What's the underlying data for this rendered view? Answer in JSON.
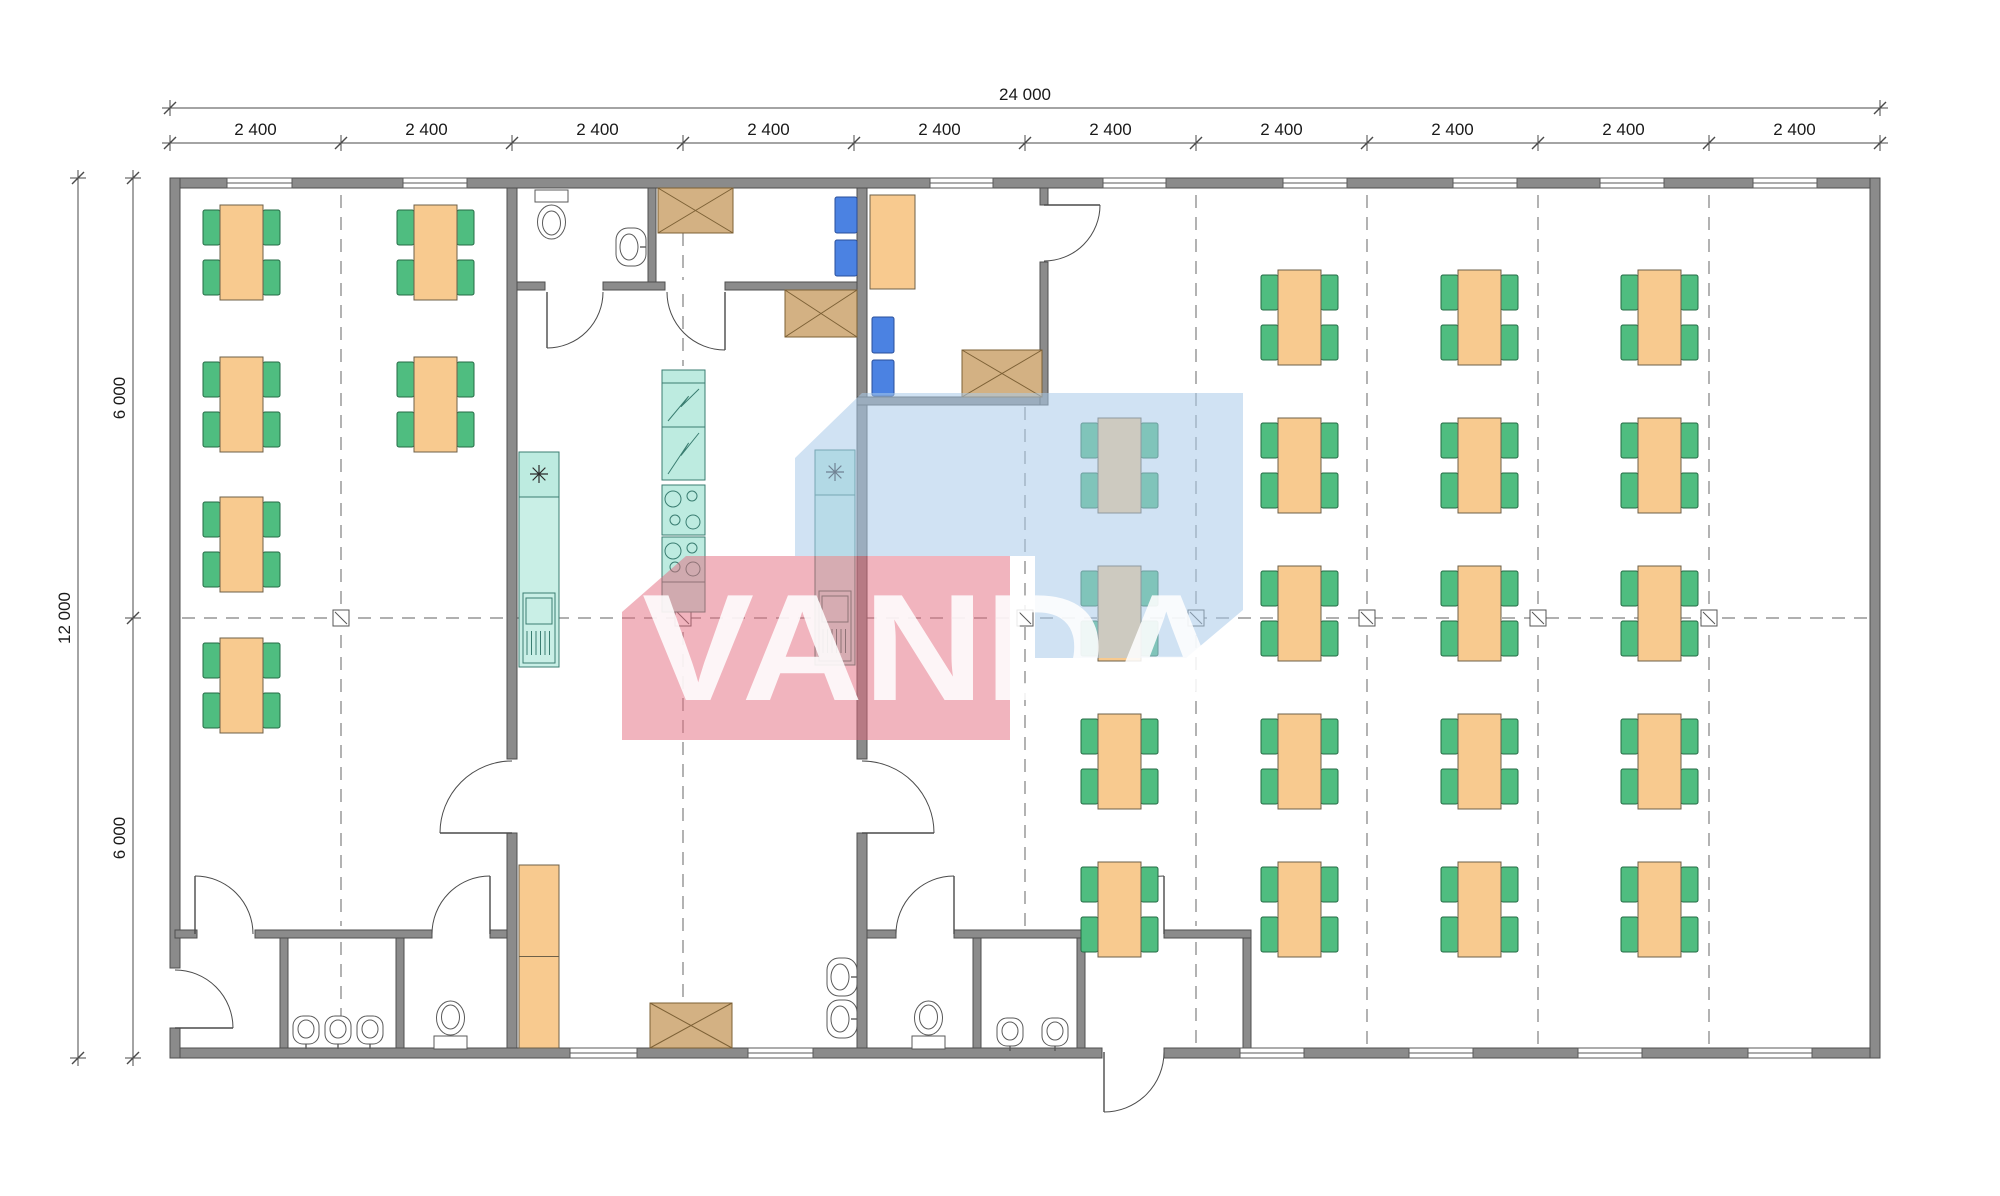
{
  "canvas": {
    "w": 2000,
    "h": 1196,
    "bg": "#ffffff"
  },
  "palette": {
    "wall": "#8b8b8b",
    "wallStroke": "#4f4f4f",
    "table": "#F8CA8F",
    "tableStroke": "#6e6048",
    "chair": "#4FBD80",
    "chairStroke": "#256b45",
    "teal": "#BDEBE0",
    "tealStroke": "#3a7d71",
    "tan": "#D3B183",
    "tanStroke": "#7d6136",
    "blue": "#4B82E2",
    "blueStroke": "#2a4f9b",
    "fixture": "#ffffff",
    "fixtureStroke": "#5a5a5a",
    "grid": "#808080",
    "dimLine": "#4a4a4a",
    "dimText": "#1a1a1a",
    "wmBlue": "#A9CBE9",
    "wmRed": "#E4697D",
    "wmText": "#ffffff"
  },
  "dimensions": {
    "top_total": {
      "label": "24 000"
    },
    "top_segments": [
      "2 400",
      "2 400",
      "2 400",
      "2 400",
      "2 400",
      "2 400",
      "2 400",
      "2 400",
      "2 400",
      "2 400"
    ],
    "left_total": {
      "label": "12 000"
    },
    "left_segments": [
      "6 000",
      "6 000"
    ]
  },
  "dim_geo": {
    "top1": {
      "y": 108,
      "x1": 170,
      "x2": 1880
    },
    "top2": {
      "y": 143,
      "ticks": [
        170,
        341,
        512,
        683,
        854,
        1025,
        1196,
        1367,
        1538,
        1709,
        1880
      ]
    },
    "left1": {
      "x": 78,
      "y1": 178,
      "y2": 1058
    },
    "left2": {
      "x": 133,
      "ticks": [
        178,
        618,
        1058
      ]
    }
  },
  "watermark": {
    "text": "VANDA",
    "blue_poly": [
      [
        862,
        393
      ],
      [
        1243,
        393
      ],
      [
        1243,
        610
      ],
      [
        1186,
        658
      ],
      [
        1035,
        658
      ],
      [
        1035,
        556
      ],
      [
        795,
        556
      ],
      [
        795,
        458
      ]
    ],
    "red_poly": [
      [
        686,
        556
      ],
      [
        1010,
        556
      ],
      [
        1010,
        740
      ],
      [
        622,
        740
      ],
      [
        622,
        612
      ]
    ],
    "text_x": 642,
    "text_y": 700,
    "text_length": 585,
    "font_size": 152
  },
  "prims": [
    {
      "t": "dash",
      "n": "grid-line-horizontal",
      "x1": 182,
      "y1": 618,
      "x2": 1868,
      "y2": 618
    },
    {
      "t": "dash",
      "n": "grid-line-vertical",
      "x1": 341,
      "y1": 195,
      "x2": 341,
      "y2": 926
    },
    {
      "t": "dash",
      "n": "grid-line-vertical",
      "x1": 341,
      "y1": 942,
      "x2": 341,
      "y2": 1044
    },
    {
      "t": "dash",
      "n": "grid-line-vertical",
      "x1": 683,
      "y1": 233,
      "x2": 683,
      "y2": 280
    },
    {
      "t": "dash",
      "n": "grid-line-vertical",
      "x1": 683,
      "y1": 294,
      "x2": 683,
      "y2": 366
    },
    {
      "t": "dash",
      "n": "grid-line-vertical",
      "x1": 683,
      "y1": 632,
      "x2": 683,
      "y2": 1000
    },
    {
      "t": "dash",
      "n": "grid-line-vertical",
      "x1": 1025,
      "y1": 407,
      "x2": 1025,
      "y2": 926
    },
    {
      "t": "dash",
      "n": "grid-line-vertical",
      "x1": 1196,
      "y1": 195,
      "x2": 1196,
      "y2": 926
    },
    {
      "t": "dash",
      "n": "grid-line-vertical",
      "x1": 1196,
      "y1": 942,
      "x2": 1196,
      "y2": 1044
    },
    {
      "t": "dash",
      "n": "grid-line-vertical",
      "x1": 1367,
      "y1": 195,
      "x2": 1367,
      "y2": 1044
    },
    {
      "t": "dash",
      "n": "grid-line-vertical",
      "x1": 1538,
      "y1": 195,
      "x2": 1538,
      "y2": 1044
    },
    {
      "t": "dash",
      "n": "grid-line-vertical",
      "x1": 1709,
      "y1": 195,
      "x2": 1709,
      "y2": 1044
    },
    {
      "t": "marker",
      "n": "grid-marker",
      "x": 333,
      "y": 610
    },
    {
      "t": "marker",
      "n": "grid-marker",
      "x": 675,
      "y": 610
    },
    {
      "t": "marker",
      "n": "grid-marker",
      "x": 1017,
      "y": 610
    },
    {
      "t": "marker",
      "n": "grid-marker",
      "x": 1188,
      "y": 610
    },
    {
      "t": "marker",
      "n": "grid-marker",
      "x": 1359,
      "y": 610
    },
    {
      "t": "marker",
      "n": "grid-marker",
      "x": 1530,
      "y": 610
    },
    {
      "t": "marker",
      "n": "grid-marker",
      "x": 1701,
      "y": 610
    },
    {
      "t": "wall",
      "n": "outer-wall-top",
      "x": 170,
      "y": 178,
      "w": 1710,
      "h": 10
    },
    {
      "t": "wall",
      "n": "outer-wall-bottom-left",
      "x": 170,
      "y": 1048,
      "w": 932,
      "h": 10
    },
    {
      "t": "wall",
      "n": "outer-wall-bottom-right",
      "x": 1164,
      "y": 1048,
      "w": 716,
      "h": 10
    },
    {
      "t": "wall",
      "n": "outer-wall-left-upper",
      "x": 170,
      "y": 178,
      "w": 10,
      "h": 790
    },
    {
      "t": "wall",
      "n": "outer-wall-left-lower",
      "x": 170,
      "y": 1028,
      "w": 10,
      "h": 30
    },
    {
      "t": "wall",
      "n": "outer-wall-right",
      "x": 1870,
      "y": 178,
      "w": 10,
      "h": 880
    },
    {
      "t": "wall",
      "n": "kitchen-west-wall-upper",
      "x": 507,
      "y": 188,
      "w": 10,
      "h": 571
    },
    {
      "t": "wall",
      "n": "kitchen-west-wall-lower",
      "x": 507,
      "y": 833,
      "w": 10,
      "h": 215
    },
    {
      "t": "wall",
      "n": "kitchen-east-wall-upper",
      "x": 857,
      "y": 188,
      "w": 10,
      "h": 571
    },
    {
      "t": "wall",
      "n": "kitchen-east-wall-lower",
      "x": 857,
      "y": 833,
      "w": 10,
      "h": 215
    },
    {
      "t": "wall",
      "n": "wc-top-block-wall",
      "x": 517,
      "y": 282,
      "w": 28,
      "h": 8
    },
    {
      "t": "wall",
      "n": "wc-top-block-wall",
      "x": 603,
      "y": 282,
      "w": 62,
      "h": 8
    },
    {
      "t": "wall",
      "n": "wc-top-block-wall",
      "x": 725,
      "y": 282,
      "w": 132,
      "h": 8
    },
    {
      "t": "wall",
      "n": "wc-divider-wall",
      "x": 648,
      "y": 188,
      "w": 8,
      "h": 94
    },
    {
      "t": "wall",
      "n": "office-south-wall",
      "x": 857,
      "y": 397,
      "w": 191,
      "h": 8
    },
    {
      "t": "wall",
      "n": "office-east-wall",
      "x": 1040,
      "y": 188,
      "w": 8,
      "h": 17
    },
    {
      "t": "wall",
      "n": "office-east-wall",
      "x": 1040,
      "y": 262,
      "w": 8,
      "h": 143
    },
    {
      "t": "wall",
      "n": "sw-block-top-wall",
      "x": 175,
      "y": 930,
      "w": 22,
      "h": 8
    },
    {
      "t": "wall",
      "n": "sw-block-top-wall",
      "x": 255,
      "y": 930,
      "w": 177,
      "h": 8
    },
    {
      "t": "wall",
      "n": "sw-block-top-wall",
      "x": 490,
      "y": 930,
      "w": 17,
      "h": 8
    },
    {
      "t": "wall",
      "n": "vestibule-washroom-divider",
      "x": 280,
      "y": 938,
      "w": 8,
      "h": 110
    },
    {
      "t": "wall",
      "n": "washroom-wc-divider",
      "x": 396,
      "y": 938,
      "w": 8,
      "h": 110
    },
    {
      "t": "wall",
      "n": "south-block-top-wall",
      "x": 867,
      "y": 930,
      "w": 29,
      "h": 8
    },
    {
      "t": "wall",
      "n": "south-block-top-wall",
      "x": 954,
      "y": 930,
      "w": 152,
      "h": 8
    },
    {
      "t": "wall",
      "n": "south-block-top-wall",
      "x": 1164,
      "y": 930,
      "w": 87,
      "h": 8
    },
    {
      "t": "wall",
      "n": "south-wc-divider",
      "x": 973,
      "y": 938,
      "w": 8,
      "h": 110
    },
    {
      "t": "wall",
      "n": "south-washroom-divider",
      "x": 1077,
      "y": 938,
      "w": 8,
      "h": 110
    },
    {
      "t": "wall",
      "n": "south-vestibule-east-wall",
      "x": 1243,
      "y": 938,
      "w": 8,
      "h": 110
    },
    {
      "t": "window",
      "n": "window",
      "x": 227,
      "y": 178,
      "w": 65
    },
    {
      "t": "window",
      "n": "window",
      "x": 403,
      "y": 178,
      "w": 64
    },
    {
      "t": "window",
      "n": "window",
      "x": 930,
      "y": 178,
      "w": 63
    },
    {
      "t": "window",
      "n": "window",
      "x": 1103,
      "y": 178,
      "w": 63
    },
    {
      "t": "window",
      "n": "window",
      "x": 1283,
      "y": 178,
      "w": 64
    },
    {
      "t": "window",
      "n": "window",
      "x": 1453,
      "y": 178,
      "w": 64
    },
    {
      "t": "window",
      "n": "window",
      "x": 1600,
      "y": 178,
      "w": 64
    },
    {
      "t": "window",
      "n": "window",
      "x": 1753,
      "y": 178,
      "w": 64
    },
    {
      "t": "window",
      "n": "window",
      "x": 570,
      "y": 1048,
      "w": 67
    },
    {
      "t": "window",
      "n": "window",
      "x": 748,
      "y": 1048,
      "w": 65
    },
    {
      "t": "window",
      "n": "window",
      "x": 1240,
      "y": 1048,
      "w": 64
    },
    {
      "t": "window",
      "n": "window",
      "x": 1409,
      "y": 1048,
      "w": 64
    },
    {
      "t": "window",
      "n": "window",
      "x": 1578,
      "y": 1048,
      "w": 64
    },
    {
      "t": "window",
      "n": "window",
      "x": 1748,
      "y": 1048,
      "w": 64
    },
    {
      "t": "door",
      "n": "door-wc-top",
      "p": [
        547,
        292
      ],
      "r": 56,
      "a1": 0,
      "a2": 90,
      "sweep": 1
    },
    {
      "t": "door",
      "n": "door-lobby-top",
      "p": [
        725,
        292
      ],
      "r": 58,
      "a1": 180,
      "a2": 90,
      "sweep": 0
    },
    {
      "t": "door",
      "n": "door-office",
      "p": [
        1044,
        205
      ],
      "r": 56,
      "a1": 90,
      "a2": 0,
      "sweep": 0
    },
    {
      "t": "door",
      "n": "door-kitchen-west",
      "p": [
        512,
        833
      ],
      "r": 72,
      "a1": 270,
      "a2": 180,
      "sweep": 0
    },
    {
      "t": "door",
      "n": "door-kitchen-east",
      "p": [
        862,
        833
      ],
      "r": 72,
      "a1": 270,
      "a2": 360,
      "sweep": 1
    },
    {
      "t": "door",
      "n": "door-vestibule-left",
      "p": [
        195,
        934
      ],
      "r": 58,
      "a1": 0,
      "a2": 270,
      "sweep": 0
    },
    {
      "t": "door",
      "n": "door-wc-southwest",
      "p": [
        490,
        934
      ],
      "r": 58,
      "a1": 180,
      "a2": 270,
      "sweep": 1
    },
    {
      "t": "door",
      "n": "door-entrance-left",
      "p": [
        175,
        1028
      ],
      "r": 58,
      "a1": 270,
      "a2": 360,
      "sweep": 1
    },
    {
      "t": "door",
      "n": "door-wc-south",
      "p": [
        954,
        934
      ],
      "r": 58,
      "a1": 180,
      "a2": 270,
      "sweep": 1
    },
    {
      "t": "door",
      "n": "door-vestibule-south",
      "p": [
        1164,
        934
      ],
      "r": 58,
      "a1": 180,
      "a2": 270,
      "sweep": 1
    },
    {
      "t": "door",
      "n": "door-entrance-south",
      "p": [
        1104,
        1052
      ],
      "r": 60,
      "a1": 0,
      "a2": 90,
      "sweep": 1
    },
    {
      "t": "vtable",
      "n": "dining-table",
      "x": 220,
      "y": 205
    },
    {
      "t": "vtable",
      "n": "dining-table",
      "x": 220,
      "y": 357
    },
    {
      "t": "vtable",
      "n": "dining-table",
      "x": 220,
      "y": 497
    },
    {
      "t": "vtable",
      "n": "dining-table",
      "x": 220,
      "y": 638
    },
    {
      "t": "vtable",
      "n": "dining-table",
      "x": 414,
      "y": 205
    },
    {
      "t": "vtable",
      "n": "dining-table",
      "x": 414,
      "y": 357
    },
    {
      "t": "vtable",
      "n": "dining-table",
      "x": 1098,
      "y": 418
    },
    {
      "t": "vtable",
      "n": "dining-table",
      "x": 1098,
      "y": 566
    },
    {
      "t": "vtable",
      "n": "dining-table",
      "x": 1098,
      "y": 714
    },
    {
      "t": "vtable",
      "n": "dining-table",
      "x": 1098,
      "y": 862
    },
    {
      "t": "vtable",
      "n": "dining-table",
      "x": 1278,
      "y": 270
    },
    {
      "t": "vtable",
      "n": "dining-table",
      "x": 1278,
      "y": 418
    },
    {
      "t": "vtable",
      "n": "dining-table",
      "x": 1278,
      "y": 566
    },
    {
      "t": "vtable",
      "n": "dining-table",
      "x": 1278,
      "y": 714
    },
    {
      "t": "vtable",
      "n": "dining-table",
      "x": 1278,
      "y": 862
    },
    {
      "t": "vtable",
      "n": "dining-table",
      "x": 1458,
      "y": 270
    },
    {
      "t": "vtable",
      "n": "dining-table",
      "x": 1458,
      "y": 418
    },
    {
      "t": "vtable",
      "n": "dining-table",
      "x": 1458,
      "y": 566
    },
    {
      "t": "vtable",
      "n": "dining-table",
      "x": 1458,
      "y": 714
    },
    {
      "t": "vtable",
      "n": "dining-table",
      "x": 1458,
      "y": 862
    },
    {
      "t": "vtable",
      "n": "dining-table",
      "x": 1638,
      "y": 270
    },
    {
      "t": "vtable",
      "n": "dining-table",
      "x": 1638,
      "y": 418
    },
    {
      "t": "vtable",
      "n": "dining-table",
      "x": 1638,
      "y": 566
    },
    {
      "t": "vtable",
      "n": "dining-table",
      "x": 1638,
      "y": 714
    },
    {
      "t": "vtable",
      "n": "dining-table",
      "x": 1638,
      "y": 862
    },
    {
      "t": "rect",
      "n": "office-desk",
      "x": 870,
      "y": 195,
      "w": 45,
      "h": 94,
      "fill": "table",
      "stroke": "tableStroke"
    },
    {
      "t": "chairb",
      "n": "blue-chair",
      "x": 835,
      "y": 197
    },
    {
      "t": "chairb",
      "n": "blue-chair",
      "x": 835,
      "y": 240
    },
    {
      "t": "chairb",
      "n": "blue-chair",
      "x": 872,
      "y": 317
    },
    {
      "t": "chairb",
      "n": "blue-chair",
      "x": 872,
      "y": 360
    },
    {
      "t": "xbox",
      "n": "cabinet-crossed",
      "x": 658,
      "y": 188,
      "w": 75,
      "h": 45
    },
    {
      "t": "xbox",
      "n": "cabinet-crossed",
      "x": 785,
      "y": 290,
      "w": 72,
      "h": 47
    },
    {
      "t": "xbox",
      "n": "cabinet-crossed",
      "x": 962,
      "y": 350,
      "w": 80,
      "h": 47
    },
    {
      "t": "xbox",
      "n": "cabinet-crossed",
      "x": 650,
      "y": 1003,
      "w": 82,
      "h": 45
    },
    {
      "t": "counter",
      "n": "kitchen-counter-west",
      "x": 519,
      "y": 452,
      "w": 40,
      "h": 215
    },
    {
      "t": "counter",
      "n": "kitchen-counter-east",
      "x": 815,
      "y": 450,
      "w": 40,
      "h": 215
    },
    {
      "t": "stack",
      "n": "kitchen-appliance-stack",
      "x": 662,
      "y": 370,
      "w": 43
    },
    {
      "t": "cab",
      "n": "kitchen-cabinet",
      "x": 519,
      "y": 865,
      "w": 40,
      "h": 183
    },
    {
      "t": "toilet",
      "n": "toilet",
      "x": 535,
      "y": 190,
      "dir": "down"
    },
    {
      "t": "toilet",
      "n": "toilet",
      "x": 434,
      "y": 1000,
      "dir": "up"
    },
    {
      "t": "toilet",
      "n": "toilet",
      "x": 912,
      "y": 1000,
      "dir": "up"
    },
    {
      "t": "sink",
      "n": "wall-sink",
      "x": 616,
      "y": 228
    },
    {
      "t": "sink",
      "n": "wall-sink",
      "x": 827,
      "y": 958
    },
    {
      "t": "sink",
      "n": "wall-sink",
      "x": 827,
      "y": 1000
    },
    {
      "t": "basin",
      "n": "wash-basin",
      "cx": 306,
      "cy": 1030
    },
    {
      "t": "basin",
      "n": "wash-basin",
      "cx": 338,
      "cy": 1030
    },
    {
      "t": "basin",
      "n": "wash-basin",
      "cx": 370,
      "cy": 1030
    },
    {
      "t": "basin",
      "n": "wash-basin",
      "cx": 1010,
      "cy": 1032
    },
    {
      "t": "basin",
      "n": "wash-basin",
      "cx": 1055,
      "cy": 1032
    }
  ]
}
